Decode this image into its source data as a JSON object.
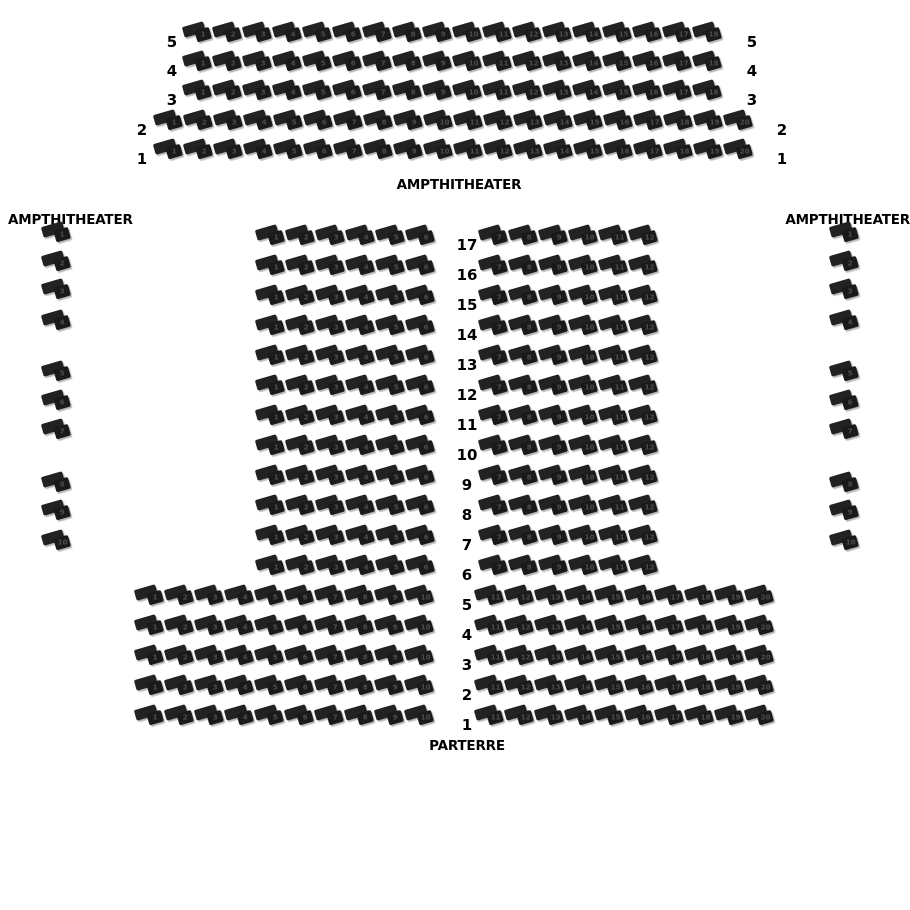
{
  "colors": {
    "background": "#ffffff",
    "seat": "#1f1f1f",
    "seat_number": "#4d4d4d",
    "label_text": "#000000"
  },
  "top_section": {
    "label": "AMPTHITHEATER",
    "rows": [
      {
        "label": "5",
        "start": 1,
        "count": 18
      },
      {
        "label": "4",
        "start": 1,
        "count": 18
      },
      {
        "label": "3",
        "start": 1,
        "count": 18
      },
      {
        "label": "2",
        "start": 1,
        "count": 20
      },
      {
        "label": "1",
        "start": 1,
        "count": 20
      }
    ]
  },
  "left_section": {
    "label": "AMPTHITHEATER",
    "seats": {
      "start": 1,
      "count": 10
    }
  },
  "right_section": {
    "label": "AMPTHITHEATER",
    "seats": {
      "start": 1,
      "count": 10
    }
  },
  "parterre": {
    "label": "PARTERRE",
    "upper_rows": [
      {
        "label": "17",
        "left": {
          "start": 1,
          "count": 6
        },
        "right": {
          "start": 7,
          "count": 6
        }
      },
      {
        "label": "16",
        "left": {
          "start": 1,
          "count": 6
        },
        "right": {
          "start": 7,
          "count": 6
        }
      },
      {
        "label": "15",
        "left": {
          "start": 1,
          "count": 6
        },
        "right": {
          "start": 7,
          "count": 6
        }
      },
      {
        "label": "14",
        "left": {
          "start": 1,
          "count": 6
        },
        "right": {
          "start": 7,
          "count": 6
        }
      },
      {
        "label": "13",
        "left": {
          "start": 1,
          "count": 6
        },
        "right": {
          "start": 7,
          "count": 6
        }
      },
      {
        "label": "12",
        "left": {
          "start": 1,
          "count": 6
        },
        "right": {
          "start": 7,
          "count": 6
        }
      },
      {
        "label": "11",
        "left": {
          "start": 1,
          "count": 6
        },
        "right": {
          "start": 7,
          "count": 6
        }
      },
      {
        "label": "10",
        "left": {
          "start": 1,
          "count": 6
        },
        "right": {
          "start": 7,
          "count": 6
        }
      },
      {
        "label": "9",
        "left": {
          "start": 1,
          "count": 6
        },
        "right": {
          "start": 7,
          "count": 6
        }
      },
      {
        "label": "8",
        "left": {
          "start": 1,
          "count": 6
        },
        "right": {
          "start": 7,
          "count": 6
        }
      },
      {
        "label": "7",
        "left": {
          "start": 1,
          "count": 6
        },
        "right": {
          "start": 7,
          "count": 6
        }
      },
      {
        "label": "6",
        "left": {
          "start": 1,
          "count": 6
        },
        "right": {
          "start": 7,
          "count": 6
        }
      }
    ],
    "lower_rows": [
      {
        "label": "5",
        "left": {
          "start": 1,
          "count": 10
        },
        "right": {
          "start": 11,
          "count": 10
        }
      },
      {
        "label": "4",
        "left": {
          "start": 1,
          "count": 10
        },
        "right": {
          "start": 11,
          "count": 10
        }
      },
      {
        "label": "3",
        "left": {
          "start": 1,
          "count": 10
        },
        "right": {
          "start": 11,
          "count": 10
        }
      },
      {
        "label": "2",
        "left": {
          "start": 1,
          "count": 10
        },
        "right": {
          "start": 11,
          "count": 10
        }
      },
      {
        "label": "1",
        "left": {
          "start": 1,
          "count": 10
        },
        "right": {
          "start": 11,
          "count": 10
        }
      }
    ]
  }
}
